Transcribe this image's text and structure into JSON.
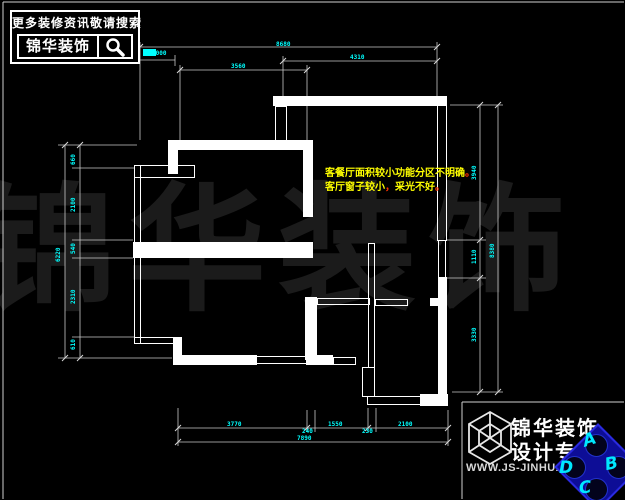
{
  "search_box": {
    "tagline": "更多装修资讯敬请搜索",
    "brand": "锦华装饰",
    "icon": "magnifier-icon"
  },
  "watermark": {
    "text": "锦华装饰"
  },
  "annotation": {
    "line1": "客餐厅面积较小功能分区不明确",
    "punct1": "。",
    "line2a": "客厅窗子较小",
    "comma": "，",
    "line2b": "采光不好",
    "punct2": "。"
  },
  "dimensions": {
    "top": {
      "total": "8680",
      "small": "1000",
      "right": "4310",
      "mid": "3560"
    },
    "left": {
      "total": "6220",
      "segments": [
        "660",
        "2100",
        "540",
        "2310",
        "610"
      ]
    },
    "right": {
      "total": "8380",
      "segments": [
        "3940",
        "1110",
        "3330"
      ]
    },
    "bottom": {
      "total": "7890",
      "segments": [
        "3770",
        "240",
        "1550",
        "230",
        "2100"
      ]
    }
  },
  "footer": {
    "brand": "锦华装饰",
    "subtitle": "设计专家",
    "url": "WWW.JS-JINHUA.COM",
    "logo": "cube-logo-icon"
  },
  "compass": {
    "letters": {
      "a": "A",
      "b": "B",
      "c": "C",
      "d": "D"
    }
  },
  "colors": {
    "background": "#000000",
    "wall": "#ffffff",
    "dimension_text": "#00ffff",
    "annotation_text": "#ffff00",
    "annotation_punct": "#ff3300",
    "dim_line": "#c9c9c9",
    "compass_fill": "#0d0d96",
    "compass_letter": "#00e8ff"
  }
}
